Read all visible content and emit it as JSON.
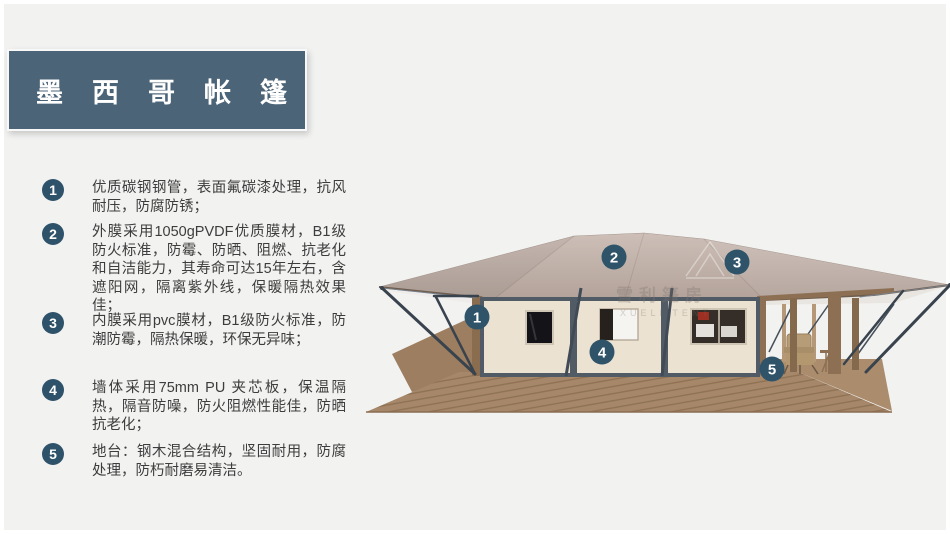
{
  "title": "墨西哥帐篷",
  "features": [
    {
      "num": "1",
      "text": "优质碳钢钢管，表面氟碳漆处理，抗风耐压，防腐防锈；"
    },
    {
      "num": "2",
      "text": "外膜采用1050gPVDF优质膜材，B1级防火标准，防霉、防晒、阻燃、抗老化和自洁能力，其寿命可达15年左右，含遮阳网，隔离紫外线，保暖隔热效果佳；"
    },
    {
      "num": "3",
      "text": "内膜采用pvc膜材，B1级防火标准，防潮防霉，隔热保暖，环保无异味；"
    },
    {
      "num": "4",
      "text": "墙体采用75mm PU 夹芯板，保温隔热，隔音防噪，防火阻燃性能佳，防晒抗老化；"
    },
    {
      "num": "5",
      "text": "地台：钢木混合结构，坚固耐用，防腐处理，防朽耐磨易清洁。"
    }
  ],
  "tent": {
    "callouts": [
      "1",
      "2",
      "3",
      "4",
      "5"
    ],
    "watermark_cn": "雪利篷房",
    "watermark_en": "XUELI TENT"
  },
  "colors": {
    "background": "#f2f2f1",
    "title_bar": "#4b6478",
    "badge": "#2e526a",
    "canopy": "#c1b2aa",
    "wall": "#ebe2d2",
    "wall_frame": "#515b66",
    "wood": "#8d7053",
    "deck": "#a6876a",
    "brace": "#39434e",
    "text": "#3d3d3d"
  }
}
